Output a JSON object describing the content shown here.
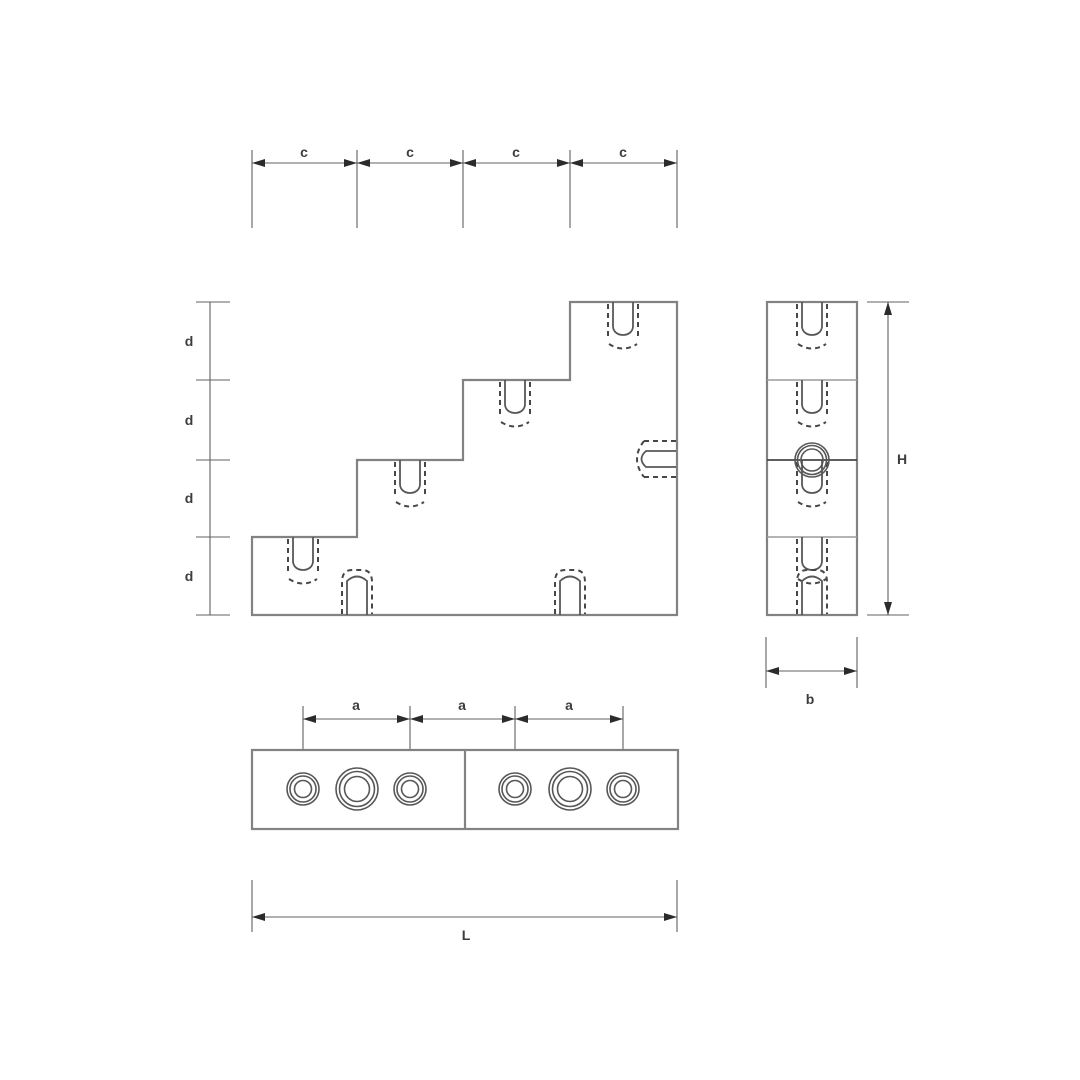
{
  "drawing": {
    "dim_c_labels": [
      "c",
      "c",
      "c",
      "c"
    ],
    "dim_d_labels": [
      "d",
      "d",
      "d",
      "d"
    ],
    "dim_a_labels": [
      "a",
      "a",
      "a"
    ],
    "dim_h_label": "H",
    "dim_b_label": "b",
    "dim_l_label": "L",
    "colors": {
      "outline": "#828282",
      "hidden_line": "#474747",
      "hole_line": "#575757",
      "dimension_line": "#616161",
      "arrow": "#2b2b2b",
      "text": "#3d3d3d",
      "seam_light": "#9c9c9c",
      "background": "#ffffff"
    }
  }
}
